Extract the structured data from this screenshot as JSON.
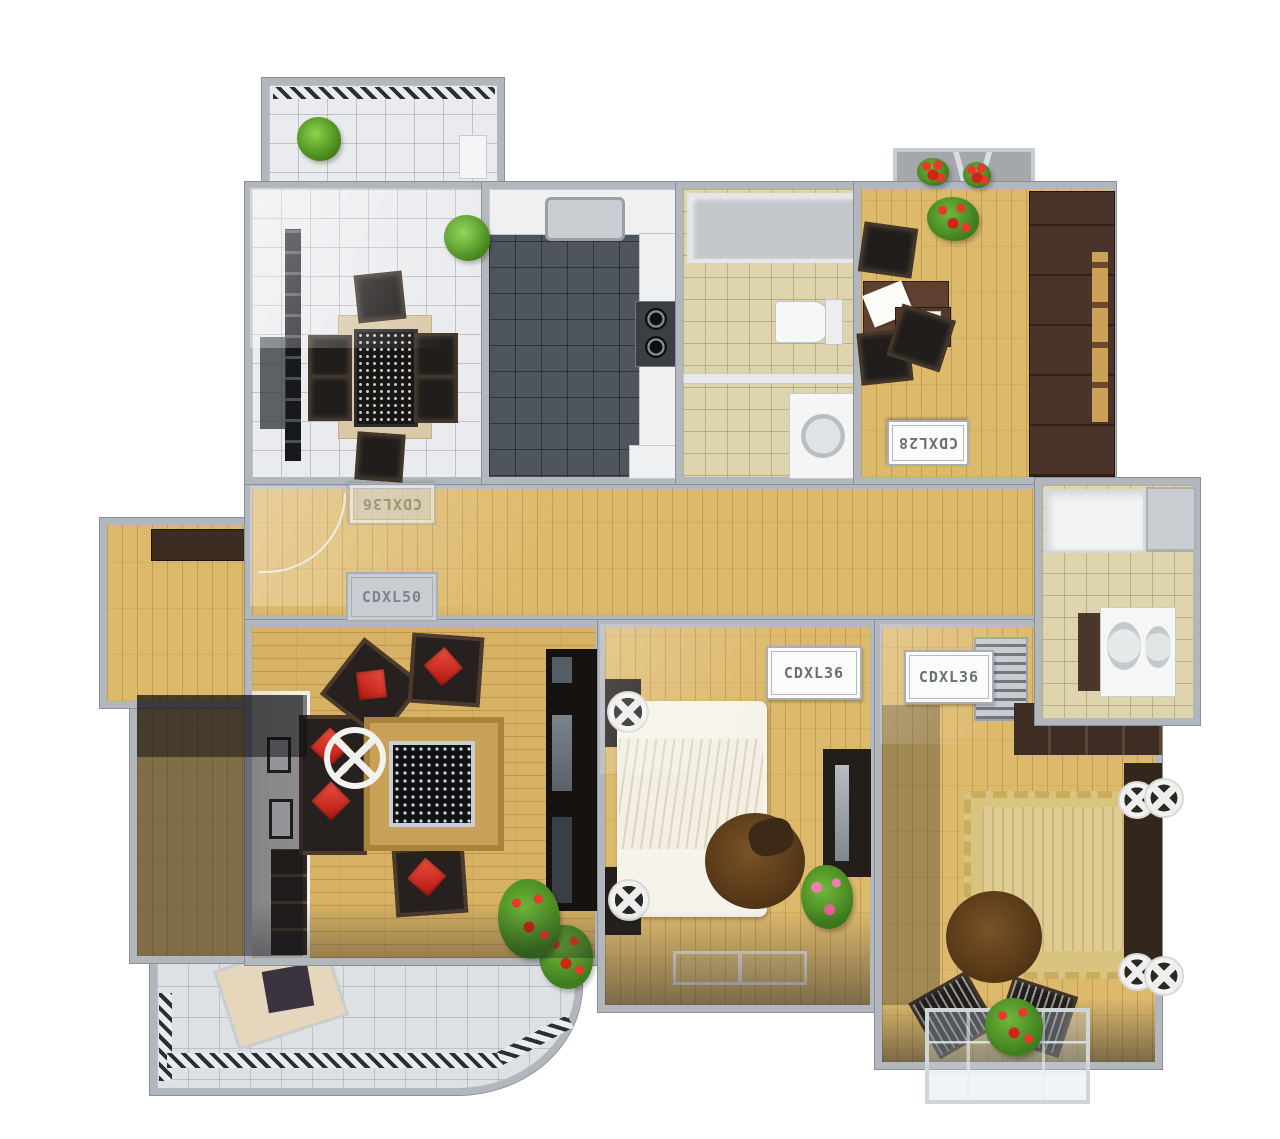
{
  "labels": {
    "hall_ac_mirrored": "CDXL36",
    "hall_ac": "CDXL50",
    "study_ac": "CDXL28",
    "bedroom1_ac": "CDXL36",
    "bedroom2_ac": "CDXL36"
  },
  "colors": {
    "background": "#ffffff",
    "wall": "#b2b7bd",
    "wall_edge": "#8a9097",
    "wood_floor": "#ddb96c",
    "tile_white": "#e9ebee",
    "tile_beige": "#ded4ad",
    "kitchen_slate": "#4e565c",
    "furniture_dark": "#241f1c",
    "furniture_brown": "#5e4030",
    "cushion_red": "#d5271d",
    "bed_white": "#f6f4ea",
    "bed_tan": "#dfcc92",
    "rug_tan": "#c8a058",
    "plant_green": "#58a02c",
    "flower_red": "#c32418",
    "glass_silver": "#cfd6da"
  }
}
